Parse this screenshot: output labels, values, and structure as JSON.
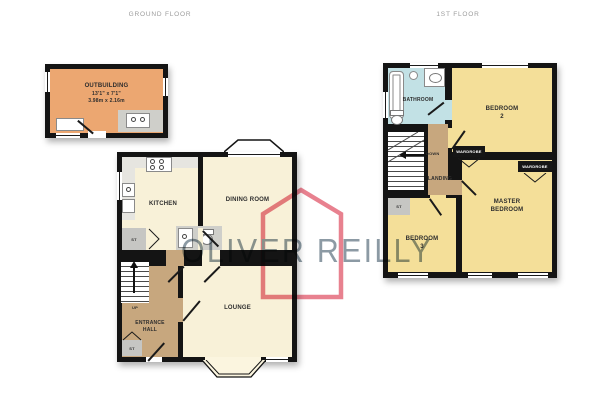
{
  "headers": {
    "ground": "GROUND FLOOR",
    "first": "1ST FLOOR"
  },
  "watermark": {
    "text": "OLIVER REILLY"
  },
  "ground_floor": {
    "outbuilding": {
      "name": "OUTBUILDING",
      "dims_ft": "13'1\" x 7'1\"",
      "dims_m": "3.98m x 2.16m"
    },
    "kitchen": "KITCHEN",
    "dining_room": "DINING ROOM",
    "lounge": "LOUNGE",
    "entrance_hall": {
      "line1": "ENTRANCE",
      "line2": "HALL"
    },
    "store_mid": "ST",
    "store_hall": "ST",
    "stairs_label": "UP"
  },
  "first_floor": {
    "bathroom": "BATHROOM",
    "bedroom2": {
      "line1": "BEDROOM",
      "line2": "2"
    },
    "bedroom3": {
      "line1": "BEDROOM",
      "line2": "3"
    },
    "master_bedroom": {
      "line1": "MASTER",
      "line2": "BEDROOM"
    },
    "landing": "LANDING",
    "store": "ST",
    "wardrobe_left": "WARDROBE",
    "wardrobe_right": "WARDROBE",
    "stairs_label": "DOWN"
  },
  "icons": {
    "hob": "four-circles",
    "sink": "oval-basin",
    "bathtub": "rounded-rect",
    "toilet": "oval-with-cistern",
    "stairs_up_arrow": "triangle-up",
    "stairs_down_arrow": "triangle-left",
    "house_watermark": "pink-house-outline"
  },
  "colors": {
    "wall": "#141414",
    "cream": "#F8F1D8",
    "tan": "#C7A77E",
    "orange": "#ECA771",
    "yellow": "#F4DF99",
    "blue": "#C2E1E5",
    "gray_st": "#C6C6C3",
    "counter": "#E6E5E0",
    "fixture_gray": "#CFCFCA",
    "watermark_pink": "#E8818F",
    "watermark_gray": "#8C9AA4",
    "header_gray": "#9B9B9B",
    "label": "#2D2D2D"
  }
}
